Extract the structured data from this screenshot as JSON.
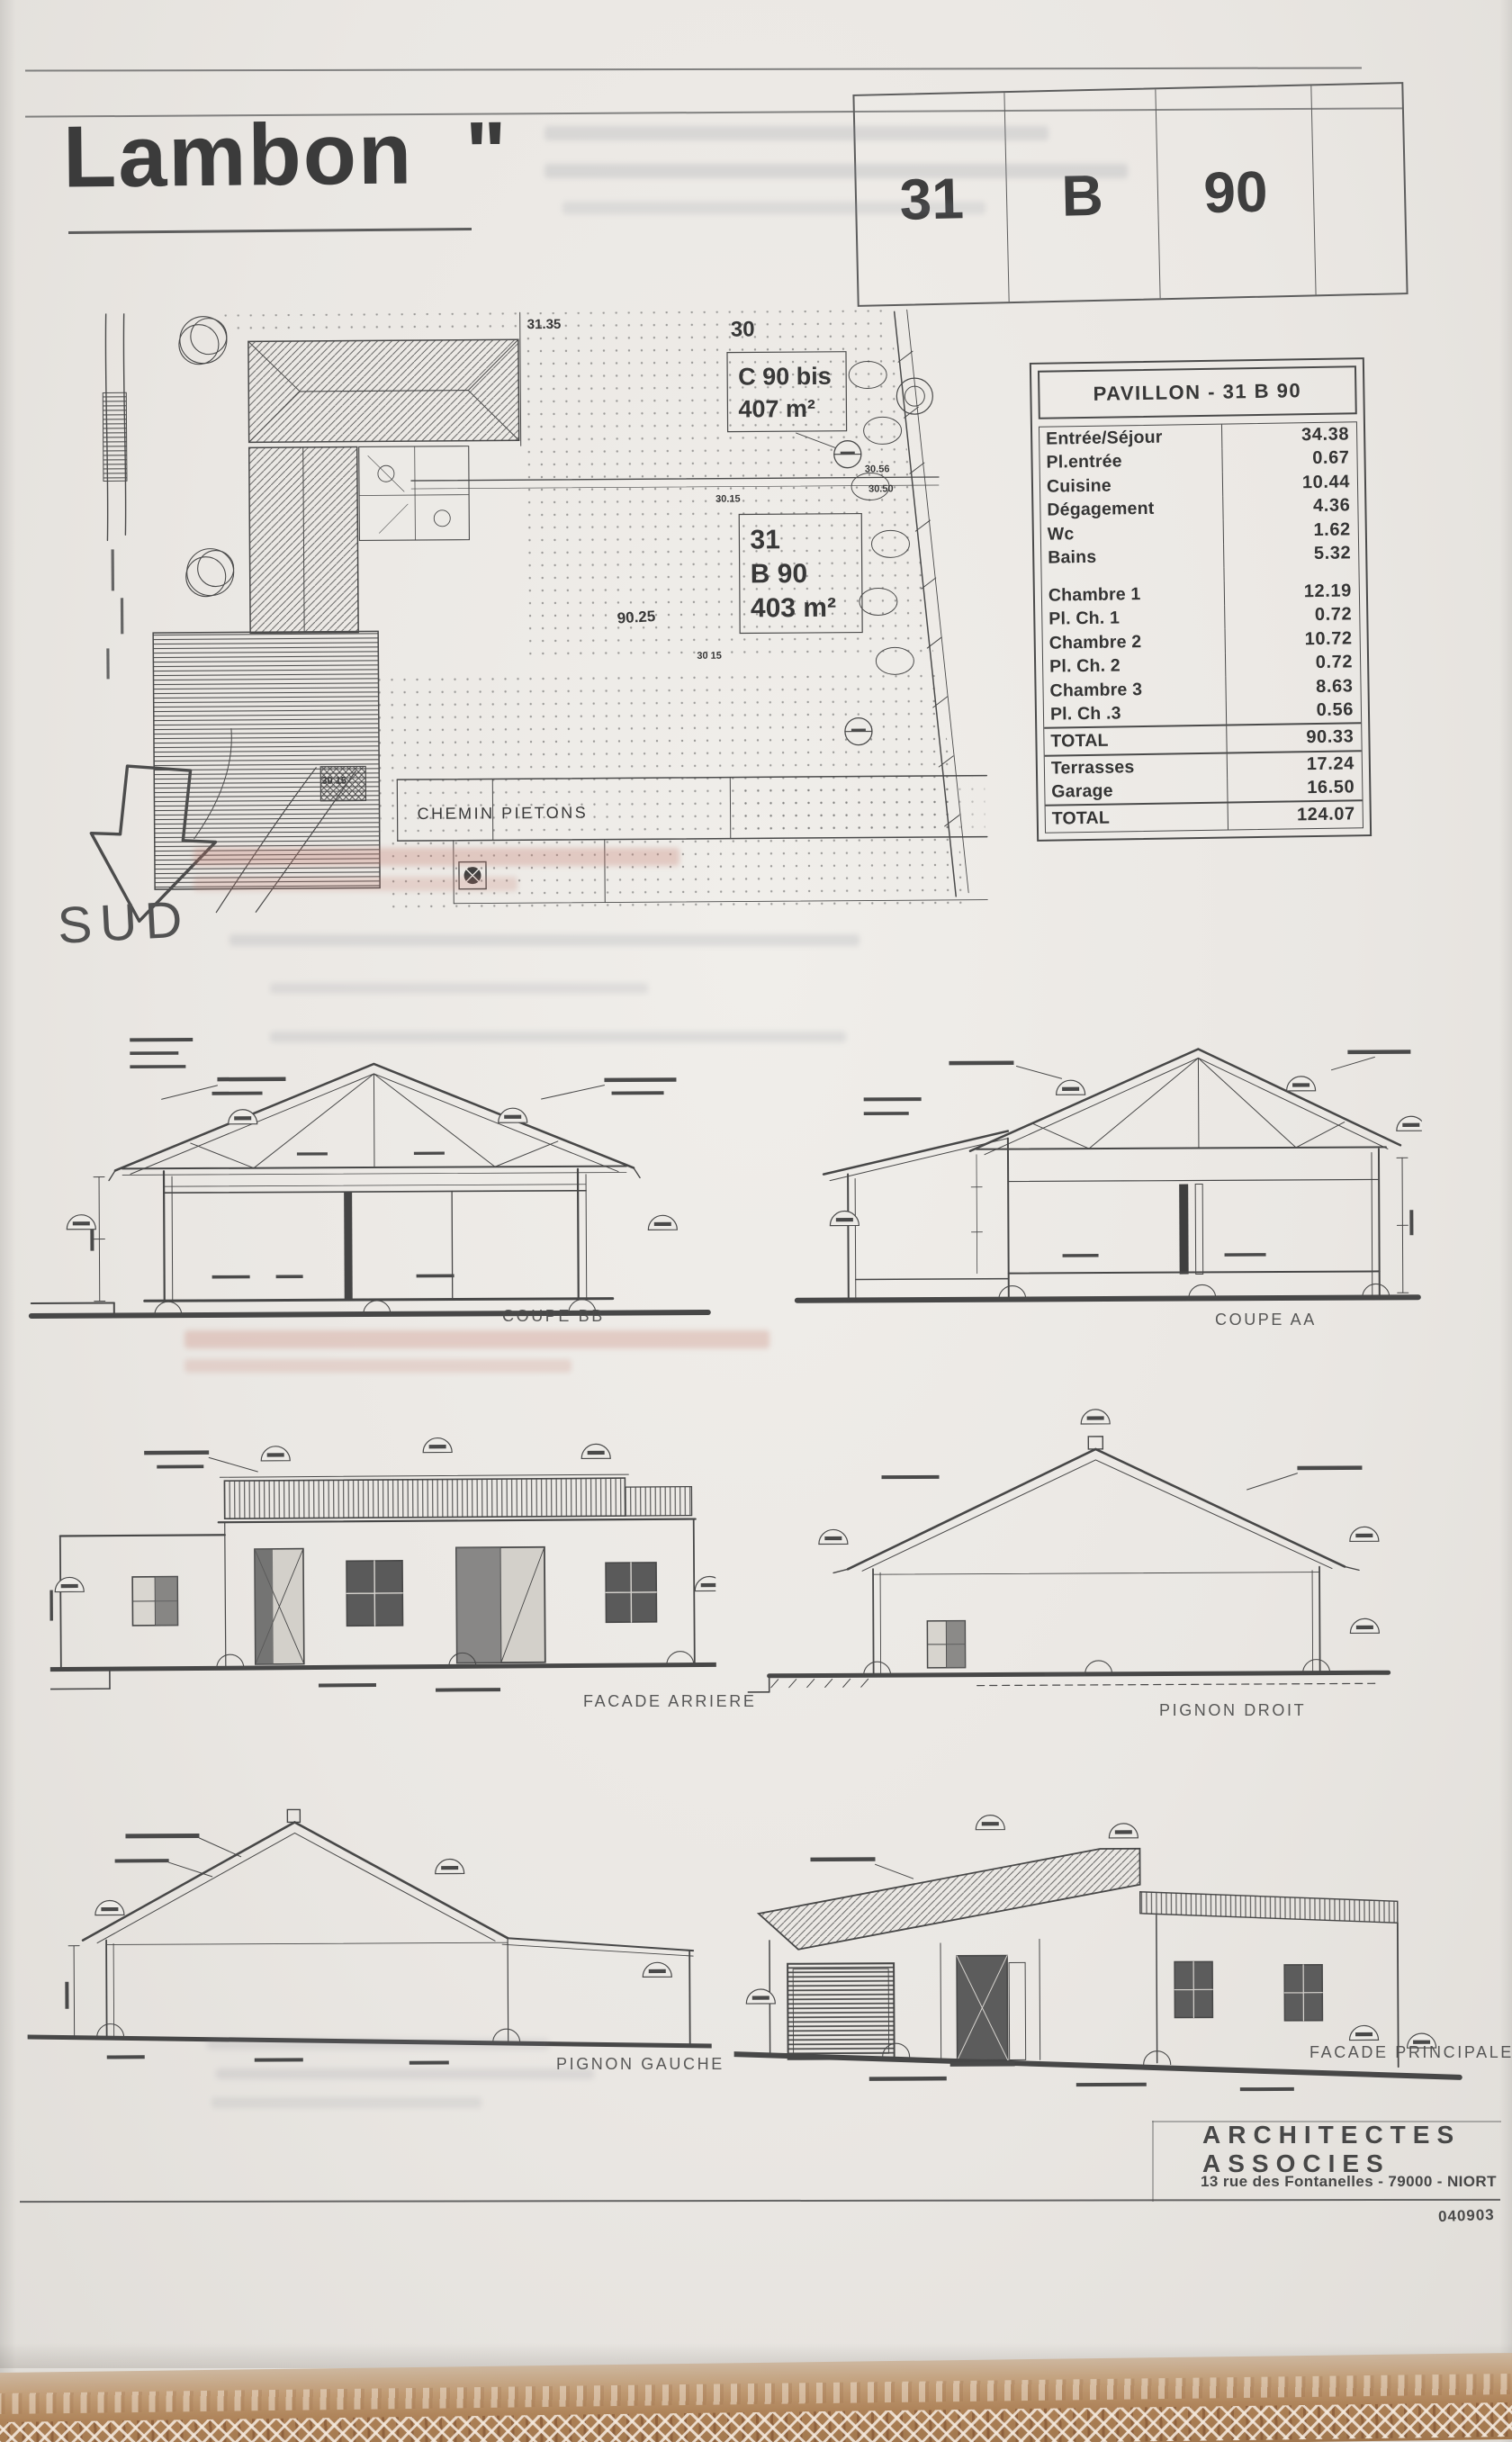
{
  "page": {
    "title": "Lambon  \"",
    "ref_cells": [
      "31",
      "B",
      "90"
    ]
  },
  "site_plan": {
    "dim_top": "31.35",
    "parcel_top": "30",
    "parcel_c90": {
      "name": "C 90 bis",
      "area": "407 m²"
    },
    "parcel_b90": {
      "line1": "31",
      "line2": "B 90",
      "area": "403 m²"
    },
    "dim_roof": "90.25",
    "dim_a": "30.15",
    "dim_b": "30 15",
    "dim_c": "30 15",
    "dim_d": "30.56",
    "dim_e": "30.50",
    "path_label": "CHEMIN PIETONS",
    "south": "SUD"
  },
  "areas_table": {
    "title": "PAVILLON  - 31 B 90",
    "rows": [
      {
        "label": "Entrée/Séjour",
        "value": "34.38"
      },
      {
        "label": "Pl.entrée",
        "value": "0.67"
      },
      {
        "label": "Cuisine",
        "value": "10.44"
      },
      {
        "label": "Dégagement",
        "value": "4.36"
      },
      {
        "label": "Wc",
        "value": "1.62"
      },
      {
        "label": "Bains",
        "value": "5.32"
      },
      {
        "label": "Chambre 1",
        "value": "12.19"
      },
      {
        "label": "Pl. Ch. 1",
        "value": "0.72"
      },
      {
        "label": "Chambre 2",
        "value": "10.72"
      },
      {
        "label": "Pl. Ch. 2",
        "value": "0.72"
      },
      {
        "label": "Chambre 3",
        "value": "8.63"
      },
      {
        "label": "Pl. Ch .3",
        "value": "0.56"
      }
    ],
    "total_main": {
      "label": "TOTAL",
      "value": "90.33"
    },
    "annex_rows": [
      {
        "label": "Terrasses",
        "value": "17.24"
      },
      {
        "label": "Garage",
        "value": "16.50"
      }
    ],
    "total_all": {
      "label": "TOTAL",
      "value": "124.07"
    }
  },
  "drawings": {
    "coupe_bb": "COUPE BB",
    "coupe_aa": "COUPE AA",
    "facade_arriere": "FACADE ARRIERE",
    "pignon_droit": "PIGNON DROIT",
    "pignon_gauche": "PIGNON GAUCHE",
    "facade_principale": "FACADE PRINCIPALE"
  },
  "stamp": {
    "name_line1": "ARCHITECTES",
    "name_line2": "ASSOCIES",
    "address": "13 rue des Fontanelles - 79000 - NIORT",
    "code": "040903"
  }
}
